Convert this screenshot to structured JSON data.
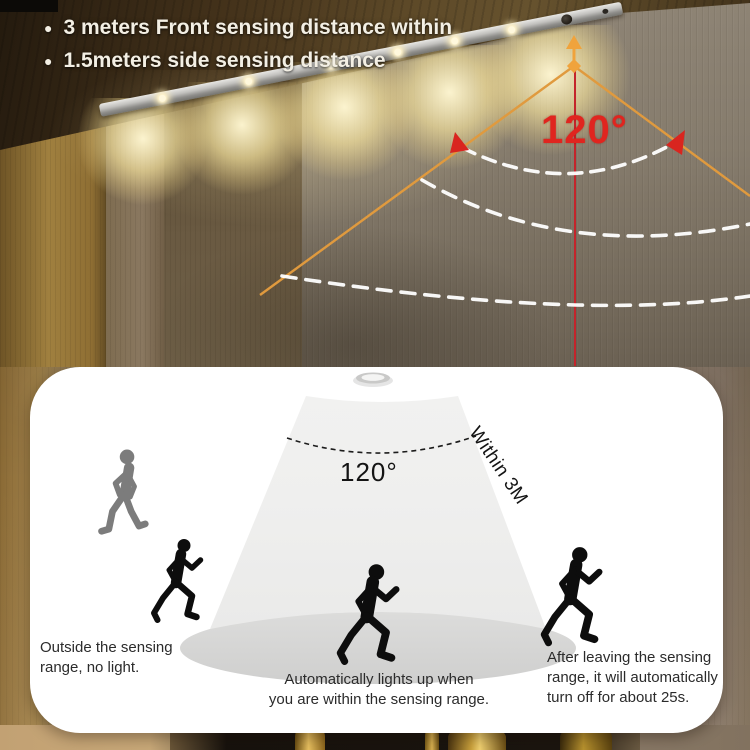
{
  "header": {
    "bullet_glyph": "●",
    "bullets": [
      "3 meters Front sensing distance within",
      "1.5meters side sensing distance"
    ],
    "angle_label": "120°"
  },
  "diagram": {
    "angle_label": "120°",
    "range_label": "Within 3M",
    "captions": {
      "left": [
        "Outside the sensing",
        "range, no light."
      ],
      "center": [
        "Automatically lights up when",
        "you are within the sensing range."
      ],
      "right": [
        "After leaving the sensing",
        "range, it will automatically",
        "turn off for about 25s."
      ]
    }
  },
  "icons": {
    "led_light_bar": "led-light-bar",
    "motion_sensor": "pir-motion-sensor",
    "downlight": "recessed-sensor-light",
    "walker": "walking-person",
    "runner": "running-person"
  },
  "colors": {
    "accent_orange": "#E89B3C",
    "accent_red": "#D9251E",
    "arc_white": "#FFFFFF",
    "warm_light": "#FFE9B0",
    "card_bg": "#FFFFFF",
    "cone_gray": "#EFEFEE",
    "pool_gray": "#D4D4D3",
    "text_dark": "#2B2B2B"
  }
}
